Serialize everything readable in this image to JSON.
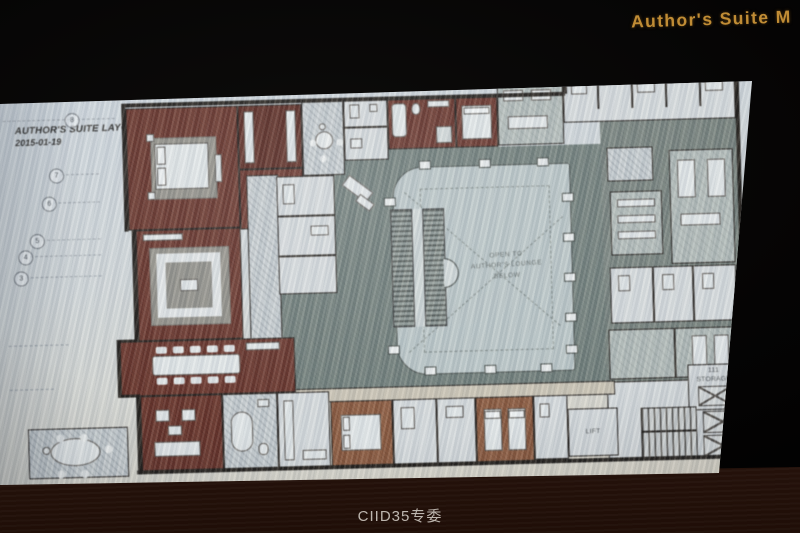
{
  "photo": {
    "slide_heading": "Author's Suite M",
    "watermark": "CIID35专委"
  },
  "plan": {
    "title_line1": "AUTHOR'S SUITE LAYOUT",
    "title_line2": "2015-01-19",
    "atrium_line1": "OPEN TO",
    "atrium_line2": "AUTHOR'S LOUNGE",
    "atrium_line3": "BELOW",
    "storage_number": "111",
    "storage_name": "STORAGE",
    "lift": "LIFT",
    "grid_bubbles": [
      "8",
      "7",
      "6",
      "5",
      "4",
      "3"
    ]
  },
  "colors": {
    "heading_gold": "#c08c35",
    "paper": "#cfd6da",
    "suite_red": "#6a2e22",
    "field_gray_green": "#6d7c77",
    "atrium_gray": "#b7c4c5",
    "bottom_room_tan": "#8f5737",
    "table_brown": "#3d2113",
    "background_black": "#050404"
  }
}
